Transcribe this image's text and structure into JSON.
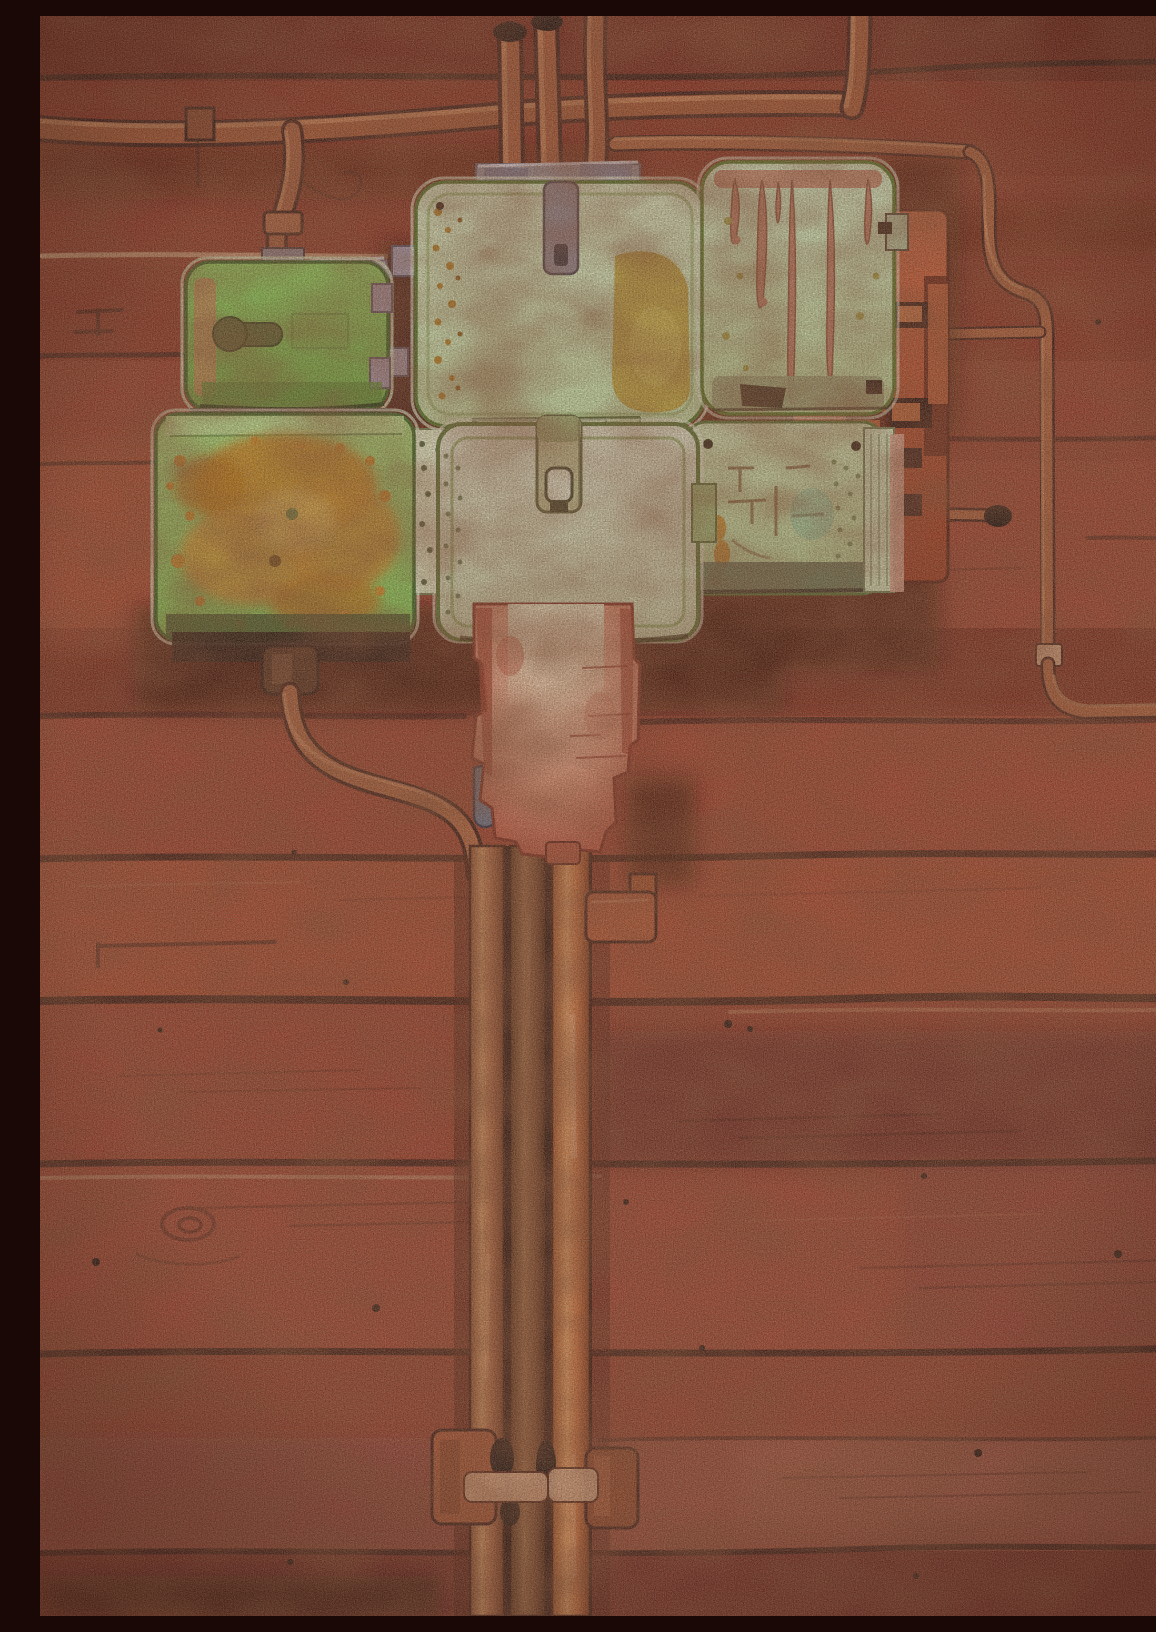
{
  "meta": {
    "title": "Watercolor — Junction Boxes on a Red Wooden Wall",
    "medium": "watercolor on paper",
    "description": "Watercolor painting of six weathered pale-green electrical junction boxes with rust stains mounted on a red-brown wooden plank wall. Copper-red conduit pipes run along the top and down the right side; a faded red conduit housing below the centre box feeds a bundle of three pipes that drops to the bottom edge, held by clamps."
  },
  "palette": {
    "wall_dark": "#6e1c0f",
    "wall_mid": "#963420",
    "wall_bright": "#aa4226",
    "wall_shadow": "#4e150b",
    "plank_line": "#2a0c05",
    "plank_highlight": "#d8ab82",
    "pipe_dark": "#38100a",
    "pipe_mid": "#a8502c",
    "pipe_highlight": "#d28454",
    "bundle_slot": "#2a0e05",
    "green_bright": "#82c84e",
    "green_mid": "#9bd162",
    "mint_pale": "#cfe9bc",
    "sage_pale": "#dfe3c8",
    "rust_orange": "#c8841a",
    "mustard": "#bf9f2e",
    "drip_salmon": "#c37a60",
    "metal_gray": "#968b94",
    "lavender_gray": "#a89aac",
    "red_box": "#c7512a",
    "housing_red": "#c05038",
    "housing_pale": "#eec5a4",
    "clamp_red": "#a84c28",
    "bracket_red": "#b5502c",
    "strap_pink": "#d9a078",
    "connector_brown": "#4a2412",
    "perforated_strip": "#e3ecc6",
    "knot_dark": "#1e0a04"
  },
  "scene": {
    "background": {
      "name": "red wooden plank wall",
      "plank_line_y": [
        62,
        238,
        340,
        445,
        700,
        843,
        985,
        1148,
        1338,
        1424,
        1537
      ],
      "knot_position": [
        148,
        1208
      ]
    },
    "boxes": [
      {
        "id": "box-top-left",
        "label": "bright green box with keyhole latch",
        "color": "#82c84e",
        "x": 146,
        "y": 246,
        "w": 202,
        "h": 148
      },
      {
        "id": "box-lower-left",
        "label": "green box heavily rusted orange",
        "color": "#9bd162",
        "x": 116,
        "y": 398,
        "w": 258,
        "h": 226
      },
      {
        "id": "box-top-center",
        "label": "pale mint box with mustard patch and gray hinge",
        "color": "#cfe9bc",
        "x": 376,
        "y": 166,
        "w": 288,
        "h": 244
      },
      {
        "id": "box-top-right",
        "label": "pale mint box with rust drips",
        "color": "#cfe9bc",
        "x": 662,
        "y": 146,
        "w": 192,
        "h": 252
      },
      {
        "id": "box-center-latch",
        "label": "pale sage box with vertical latch tab",
        "color": "#dfe3c8",
        "x": 398,
        "y": 408,
        "w": 260,
        "h": 216
      },
      {
        "id": "box-right-small",
        "label": "pale green box with scratches and end cap",
        "color": "#cde0ae",
        "x": 646,
        "y": 406,
        "w": 196,
        "h": 172
      }
    ],
    "pipes": [
      {
        "id": "pipe-top-horizontal",
        "label": "horizontal conduit across upper wall with riser at right"
      },
      {
        "id": "pipe-branch-left",
        "label": "curved branch dropping to top-left box"
      },
      {
        "id": "pipe-top-stubs",
        "label": "three vertical stubs entering top-center box"
      },
      {
        "id": "pipe-right-run",
        "label": "thin conduit descending right side with coupling and bottom elbow"
      },
      {
        "id": "pipe-bundle",
        "label": "three vertical pipes dropping from housing to bottom edge"
      },
      {
        "id": "pipe-left-drop",
        "label": "curved pipe from lower-left box joining the bundle"
      }
    ],
    "housing": {
      "id": "conduit-housing",
      "label": "faded red conduit housing below centre box",
      "x": 430,
      "y": 588,
      "w": 170,
      "h": 250
    },
    "clamps": [
      {
        "id": "clamp-upper-right",
        "label": "T-bracket beside bundle",
        "y": 876
      },
      {
        "id": "clamp-bottom-left",
        "label": "bottom clamp with strap",
        "y": 1414
      },
      {
        "id": "clamp-bottom-right",
        "label": "bottom clamp with strap",
        "y": 1432
      }
    ]
  }
}
